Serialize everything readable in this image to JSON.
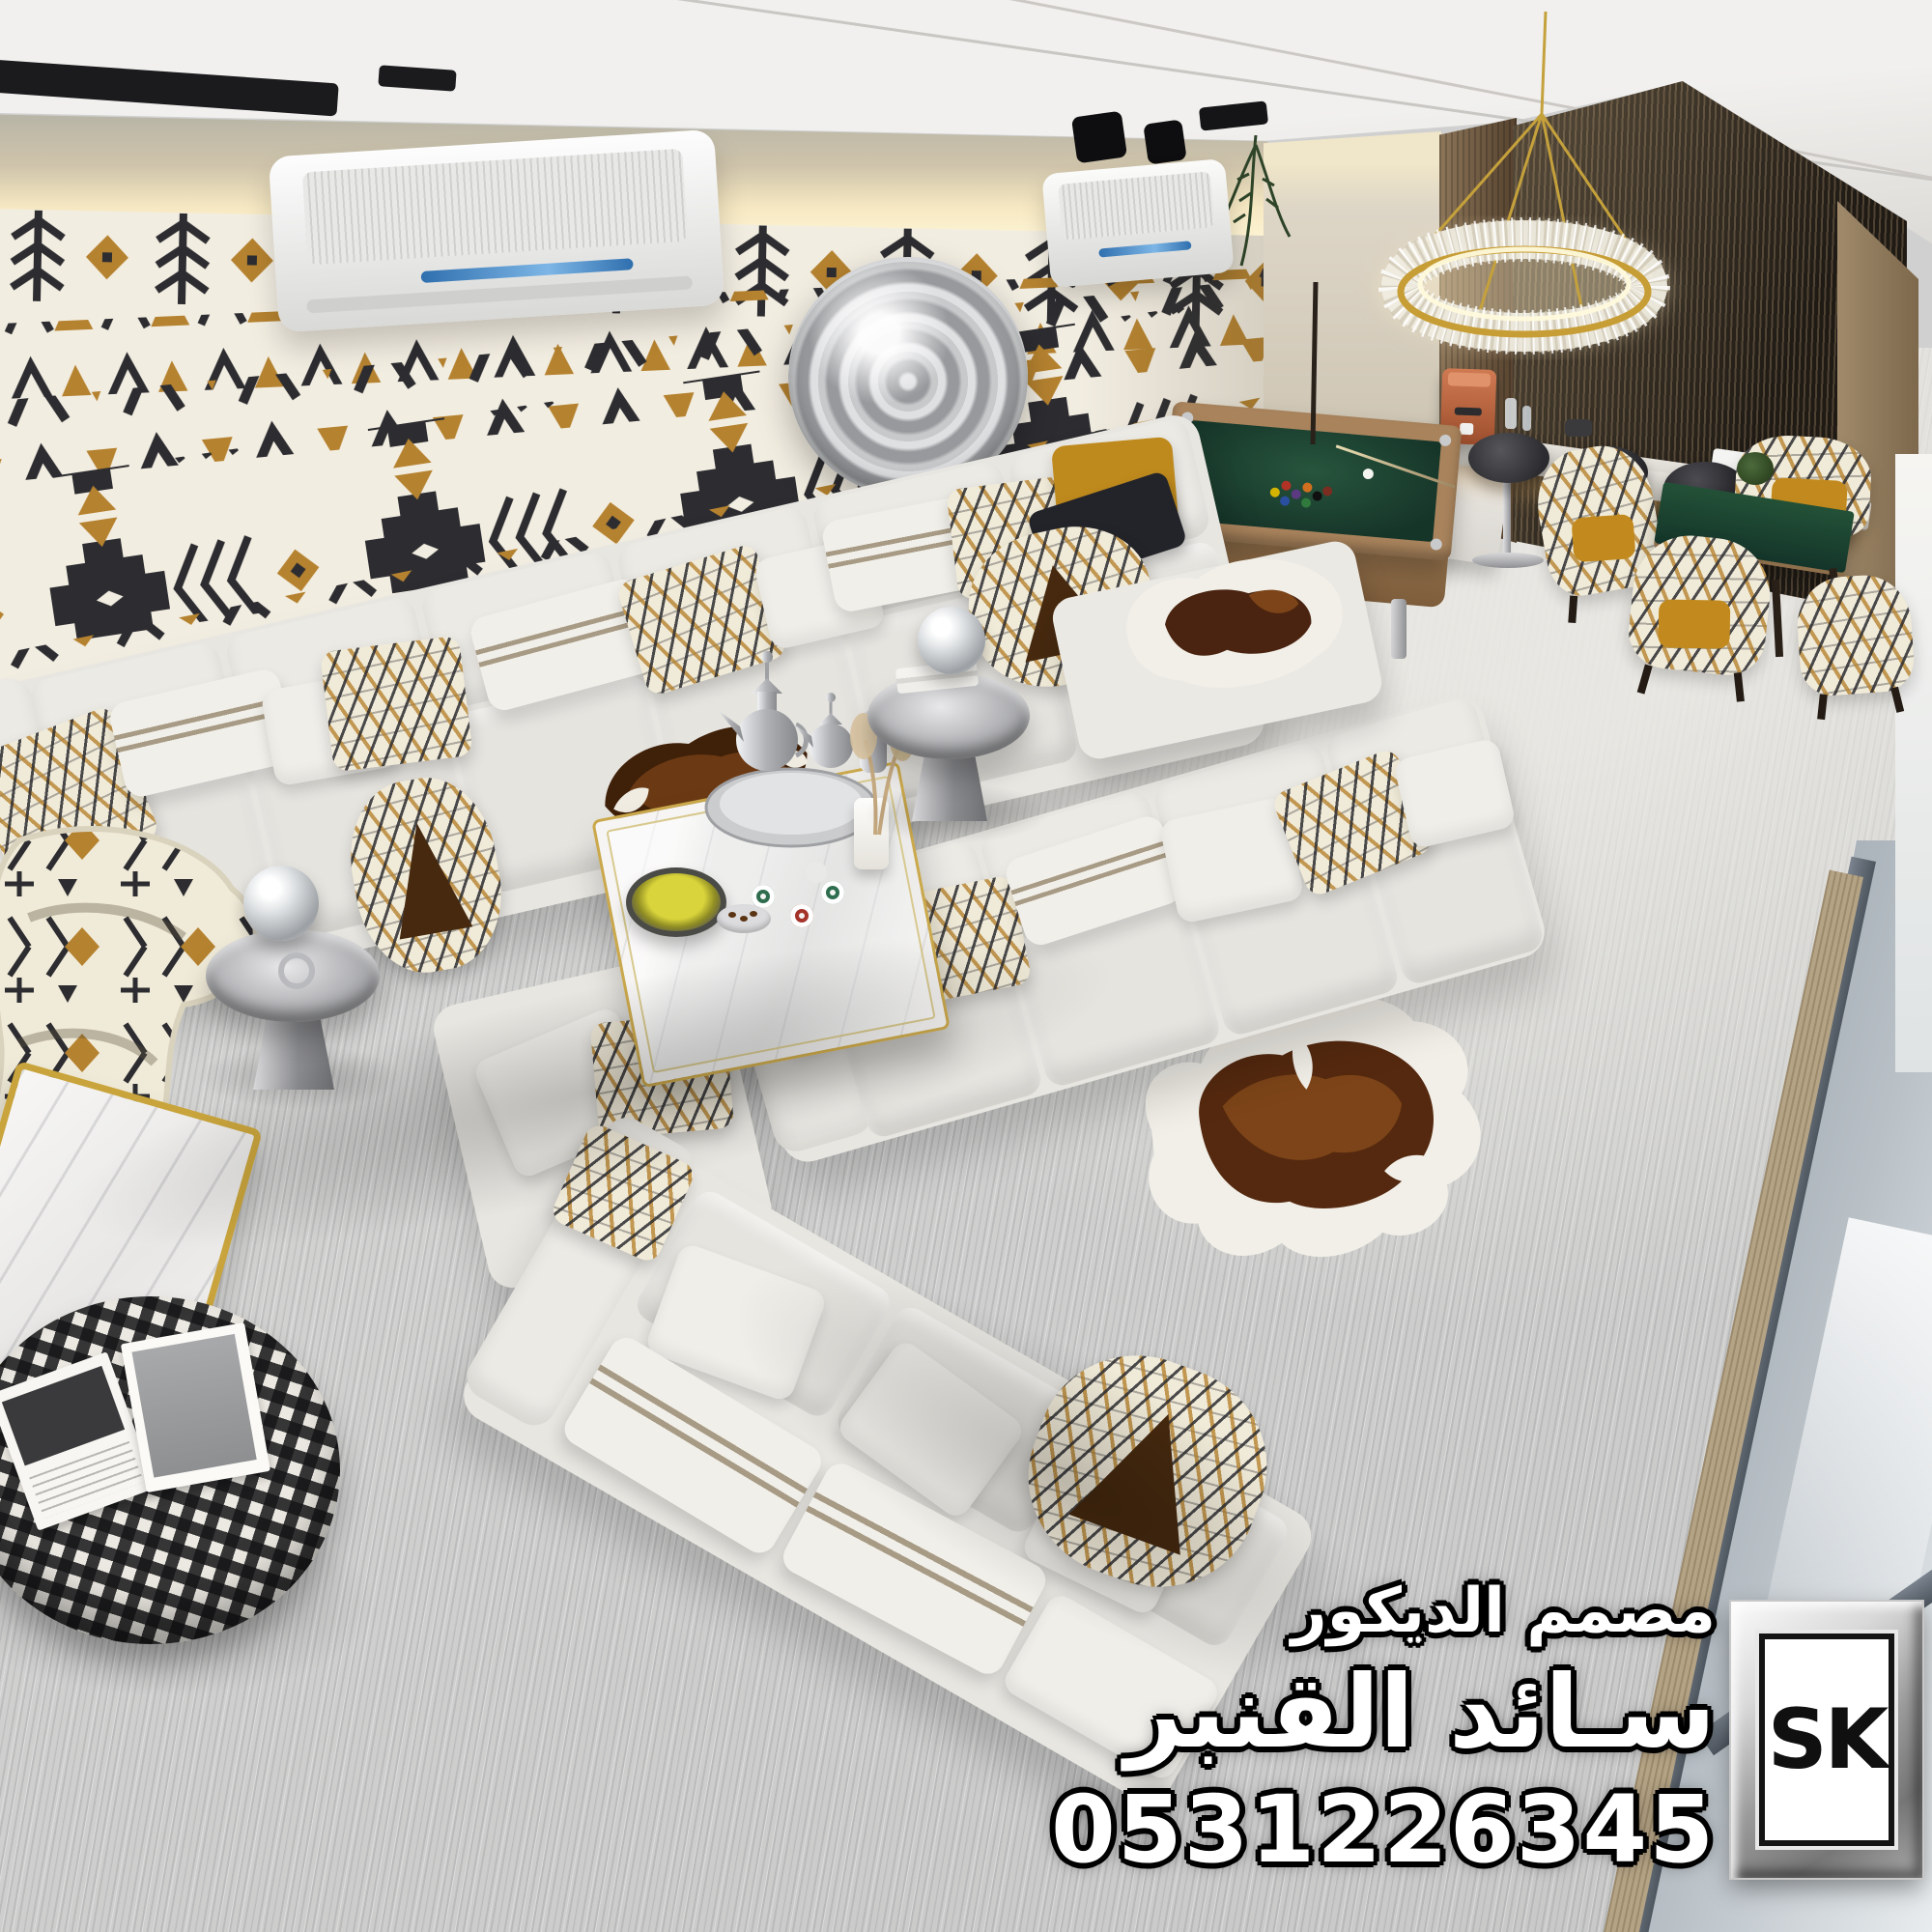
{
  "watermark": {
    "designer_title": "مصمم الديكور",
    "designer_name": "سـائد القنبر",
    "phone": "0531226345",
    "logo_text": "SK"
  },
  "palette": {
    "pattern_black": "#2d2d31",
    "pattern_tan": "#b5822f",
    "wall_cream": "#f2ede1",
    "sofa_white": "#e8e6e1",
    "carpet_gray": "#cfd0cf",
    "billiard_felt_green": "#1f4935",
    "gold_accent": "#c9a43c",
    "slat_wood_dark": "#332b22",
    "cowhide_brown": "#55290f",
    "mustard": "#bf8a1d"
  }
}
